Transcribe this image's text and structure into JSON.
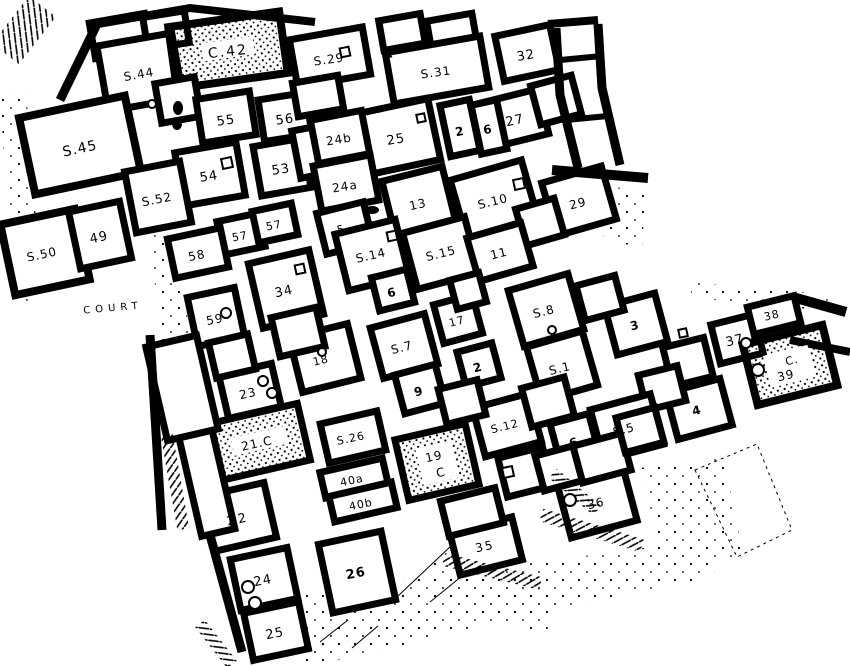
{
  "figure": {
    "kind": "excavation-site-plan",
    "colors": {
      "ink": "#000000",
      "paper": "#ffffff"
    }
  },
  "map": {
    "labels": [
      {
        "text": "C.42",
        "x": 228,
        "y": 52,
        "size": 14,
        "ls": 2,
        "rot": -6
      },
      {
        "text": "S.44",
        "x": 139,
        "y": 75,
        "size": 12,
        "rot": -10
      },
      {
        "text": "S.29",
        "x": 329,
        "y": 60,
        "size": 12,
        "rot": -8
      },
      {
        "text": "S.31",
        "x": 436,
        "y": 73,
        "size": 12,
        "rot": -8
      },
      {
        "text": "32",
        "x": 526,
        "y": 56,
        "size": 13,
        "rot": -10
      },
      {
        "text": "55",
        "x": 226,
        "y": 121,
        "size": 13,
        "rot": -8
      },
      {
        "text": "56",
        "x": 285,
        "y": 120,
        "size": 13,
        "rot": -8
      },
      {
        "text": "27",
        "x": 515,
        "y": 121,
        "size": 13,
        "rot": -12
      },
      {
        "text": "2",
        "x": 460,
        "y": 132,
        "size": 12,
        "bold": true,
        "rot": -10
      },
      {
        "text": "6",
        "x": 488,
        "y": 130,
        "size": 12,
        "bold": true,
        "rot": -10
      },
      {
        "text": "25",
        "x": 396,
        "y": 140,
        "size": 13,
        "rot": -10
      },
      {
        "text": "24b",
        "x": 339,
        "y": 140,
        "size": 12,
        "rot": -9
      },
      {
        "text": "S.45",
        "x": 80,
        "y": 149,
        "size": 14,
        "rot": -12
      },
      {
        "text": "54",
        "x": 209,
        "y": 177,
        "size": 13,
        "rot": -9
      },
      {
        "text": "53",
        "x": 281,
        "y": 170,
        "size": 13,
        "rot": -9
      },
      {
        "text": "24a",
        "x": 345,
        "y": 187,
        "size": 12,
        "rot": -9
      },
      {
        "text": "S.52",
        "x": 157,
        "y": 200,
        "size": 12,
        "rot": -11
      },
      {
        "text": "13",
        "x": 418,
        "y": 205,
        "size": 12,
        "rot": -12
      },
      {
        "text": "S.10",
        "x": 493,
        "y": 202,
        "size": 12,
        "rot": -14
      },
      {
        "text": "29",
        "x": 578,
        "y": 204,
        "size": 12,
        "rot": -14
      },
      {
        "text": "49",
        "x": 99,
        "y": 238,
        "size": 13,
        "rot": -12
      },
      {
        "text": "S.50",
        "x": 42,
        "y": 255,
        "size": 12,
        "rot": -12
      },
      {
        "text": "57",
        "x": 240,
        "y": 237,
        "size": 11,
        "rot": -11
      },
      {
        "text": "57",
        "x": 274,
        "y": 226,
        "size": 11,
        "rot": -11
      },
      {
        "text": "58",
        "x": 197,
        "y": 256,
        "size": 12,
        "rot": -11
      },
      {
        "text": "5",
        "x": 341,
        "y": 230,
        "size": 11,
        "rot": -12
      },
      {
        "text": "S.14",
        "x": 371,
        "y": 256,
        "size": 12,
        "rot": -13
      },
      {
        "text": "S.15",
        "x": 441,
        "y": 254,
        "size": 12,
        "rot": -14
      },
      {
        "text": "11",
        "x": 499,
        "y": 254,
        "size": 12,
        "rot": -14
      },
      {
        "text": "34",
        "x": 284,
        "y": 292,
        "size": 13,
        "rot": -12
      },
      {
        "text": "COURT",
        "x": 113,
        "y": 308,
        "size": 10,
        "ls": 5,
        "rot": -5
      },
      {
        "text": "59",
        "x": 215,
        "y": 320,
        "size": 12,
        "rot": -11
      },
      {
        "text": "6",
        "x": 392,
        "y": 293,
        "size": 12,
        "bold": true,
        "rot": -13
      },
      {
        "text": "17",
        "x": 457,
        "y": 322,
        "size": 11,
        "rot": -14
      },
      {
        "text": "S.8",
        "x": 544,
        "y": 312,
        "size": 12,
        "rot": -14
      },
      {
        "text": "3",
        "x": 635,
        "y": 326,
        "size": 12,
        "bold": true,
        "rot": -14
      },
      {
        "text": "38",
        "x": 772,
        "y": 316,
        "size": 11,
        "rot": -13
      },
      {
        "text": "37",
        "x": 735,
        "y": 341,
        "size": 13,
        "rot": -13
      },
      {
        "text": "C.",
        "x": 792,
        "y": 361,
        "size": 11,
        "rot": -13
      },
      {
        "text": "39",
        "x": 786,
        "y": 376,
        "size": 12,
        "rot": -13
      },
      {
        "text": "18",
        "x": 321,
        "y": 361,
        "size": 11,
        "rot": -13
      },
      {
        "text": "S.7",
        "x": 402,
        "y": 348,
        "size": 12,
        "rot": -14
      },
      {
        "text": "2",
        "x": 478,
        "y": 368,
        "size": 12,
        "bold": true,
        "rot": -14
      },
      {
        "text": "S.1",
        "x": 560,
        "y": 369,
        "size": 12,
        "rot": -14
      },
      {
        "text": "23",
        "x": 248,
        "y": 394,
        "size": 12,
        "rot": -12
      },
      {
        "text": "9",
        "x": 419,
        "y": 392,
        "size": 12,
        "bold": true,
        "rot": -14
      },
      {
        "text": "4",
        "x": 697,
        "y": 411,
        "size": 12,
        "bold": true,
        "rot": -14
      },
      {
        "text": "S.5",
        "x": 624,
        "y": 430,
        "size": 12,
        "rot": -14
      },
      {
        "text": "S.12",
        "x": 505,
        "y": 427,
        "size": 11,
        "rot": -14
      },
      {
        "text": "6",
        "x": 574,
        "y": 443,
        "size": 12,
        "bold": true,
        "rot": -14
      },
      {
        "text": "21.C",
        "x": 257,
        "y": 444,
        "size": 12,
        "rot": -12
      },
      {
        "text": "S.26",
        "x": 351,
        "y": 439,
        "size": 11,
        "rot": -12
      },
      {
        "text": "19",
        "x": 434,
        "y": 457,
        "size": 12,
        "rot": -12
      },
      {
        "text": "C",
        "x": 441,
        "y": 473,
        "size": 12,
        "rot": -12
      },
      {
        "text": "40a",
        "x": 352,
        "y": 481,
        "size": 11,
        "rot": -12
      },
      {
        "text": "40b",
        "x": 361,
        "y": 505,
        "size": 11,
        "rot": -12
      },
      {
        "text": "22",
        "x": 238,
        "y": 520,
        "size": 13,
        "ls": 3,
        "rot": -12
      },
      {
        "text": "36",
        "x": 596,
        "y": 504,
        "size": 12,
        "rot": -13
      },
      {
        "text": "35",
        "x": 485,
        "y": 547,
        "size": 12,
        "ls": 2,
        "rot": -12
      },
      {
        "text": "24",
        "x": 263,
        "y": 581,
        "size": 13,
        "rot": -11
      },
      {
        "text": "26",
        "x": 356,
        "y": 574,
        "size": 13,
        "bold": true,
        "rot": -11
      },
      {
        "text": "25",
        "x": 275,
        "y": 634,
        "size": 13,
        "rot": -11
      }
    ],
    "rooms": [
      {
        "cx": 120,
        "cy": 36,
        "w": 56,
        "h": 36,
        "rot": -10
      },
      {
        "cx": 166,
        "cy": 30,
        "w": 42,
        "h": 32,
        "rot": -9
      },
      {
        "cx": 140,
        "cy": 72,
        "w": 76,
        "h": 66,
        "rot": -10
      },
      {
        "cx": 228,
        "cy": 50,
        "w": 112,
        "h": 62,
        "rot": -8,
        "fill": "stipple",
        "sw": 8
      },
      {
        "cx": 178,
        "cy": 100,
        "w": 40,
        "h": 40,
        "rot": -10
      },
      {
        "cx": 80,
        "cy": 145,
        "w": 108,
        "h": 78,
        "rot": -12,
        "sw": 8
      },
      {
        "cx": 45,
        "cy": 252,
        "w": 76,
        "h": 72,
        "rot": -12,
        "sw": 8
      },
      {
        "cx": 100,
        "cy": 235,
        "w": 52,
        "h": 58,
        "rot": -12
      },
      {
        "cx": 226,
        "cy": 117,
        "w": 54,
        "h": 44,
        "rot": -9
      },
      {
        "cx": 285,
        "cy": 117,
        "w": 48,
        "h": 42,
        "rot": -9
      },
      {
        "cx": 210,
        "cy": 174,
        "w": 62,
        "h": 54,
        "rot": -10
      },
      {
        "cx": 282,
        "cy": 167,
        "w": 50,
        "h": 50,
        "rot": -10
      },
      {
        "cx": 158,
        "cy": 197,
        "w": 56,
        "h": 62,
        "rot": -11
      },
      {
        "cx": 310,
        "cy": 152,
        "w": 28,
        "h": 48,
        "rot": -11
      },
      {
        "cx": 330,
        "cy": 57,
        "w": 74,
        "h": 48,
        "rot": -10
      },
      {
        "cx": 318,
        "cy": 96,
        "w": 46,
        "h": 34,
        "rot": -10
      },
      {
        "cx": 402,
        "cy": 32,
        "w": 42,
        "h": 30,
        "rot": -10
      },
      {
        "cx": 452,
        "cy": 33,
        "w": 46,
        "h": 32,
        "rot": -10
      },
      {
        "cx": 437,
        "cy": 70,
        "w": 96,
        "h": 52,
        "rot": -10
      },
      {
        "cx": 527,
        "cy": 53,
        "w": 56,
        "h": 46,
        "rot": -12
      },
      {
        "cx": 516,
        "cy": 118,
        "w": 56,
        "h": 46,
        "rot": -14
      },
      {
        "cx": 556,
        "cy": 100,
        "w": 42,
        "h": 40,
        "rot": -15
      },
      {
        "cx": 460,
        "cy": 128,
        "w": 30,
        "h": 52,
        "rot": -12
      },
      {
        "cx": 489,
        "cy": 127,
        "w": 26,
        "h": 50,
        "rot": -12
      },
      {
        "cx": 397,
        "cy": 137,
        "w": 76,
        "h": 62,
        "rot": -12
      },
      {
        "cx": 340,
        "cy": 137,
        "w": 52,
        "h": 44,
        "rot": -11
      },
      {
        "cx": 346,
        "cy": 183,
        "w": 58,
        "h": 46,
        "rot": -11
      },
      {
        "cx": 419,
        "cy": 202,
        "w": 62,
        "h": 58,
        "rot": -14
      },
      {
        "cx": 494,
        "cy": 199,
        "w": 74,
        "h": 60,
        "rot": -16
      },
      {
        "cx": 579,
        "cy": 201,
        "w": 62,
        "h": 55,
        "rot": -16
      },
      {
        "cx": 540,
        "cy": 222,
        "w": 40,
        "h": 38,
        "rot": -16
      },
      {
        "cx": 241,
        "cy": 234,
        "w": 42,
        "h": 34,
        "rot": -12
      },
      {
        "cx": 275,
        "cy": 223,
        "w": 40,
        "h": 32,
        "rot": -12
      },
      {
        "cx": 198,
        "cy": 253,
        "w": 54,
        "h": 40,
        "rot": -12
      },
      {
        "cx": 345,
        "cy": 228,
        "w": 48,
        "h": 42,
        "rot": -14
      },
      {
        "cx": 372,
        "cy": 255,
        "w": 62,
        "h": 58,
        "rot": -14
      },
      {
        "cx": 441,
        "cy": 253,
        "w": 64,
        "h": 58,
        "rot": -15
      },
      {
        "cx": 500,
        "cy": 252,
        "w": 56,
        "h": 45,
        "rot": -16
      },
      {
        "cx": 286,
        "cy": 289,
        "w": 62,
        "h": 66,
        "rot": -13
      },
      {
        "cx": 216,
        "cy": 317,
        "w": 48,
        "h": 50,
        "rot": -12
      },
      {
        "cx": 393,
        "cy": 290,
        "w": 36,
        "h": 34,
        "rot": -14
      },
      {
        "cx": 458,
        "cy": 319,
        "w": 40,
        "h": 40,
        "rot": -15
      },
      {
        "cx": 468,
        "cy": 291,
        "w": 30,
        "h": 30,
        "rot": -15
      },
      {
        "cx": 546,
        "cy": 310,
        "w": 62,
        "h": 58,
        "rot": -16
      },
      {
        "cx": 325,
        "cy": 358,
        "w": 60,
        "h": 56,
        "rot": -14
      },
      {
        "cx": 404,
        "cy": 346,
        "w": 56,
        "h": 52,
        "rot": -15
      },
      {
        "cx": 479,
        "cy": 365,
        "w": 36,
        "h": 36,
        "rot": -15
      },
      {
        "cx": 562,
        "cy": 366,
        "w": 58,
        "h": 56,
        "rot": -16
      },
      {
        "cx": 420,
        "cy": 389,
        "w": 42,
        "h": 40,
        "rot": -15
      },
      {
        "cx": 250,
        "cy": 391,
        "w": 54,
        "h": 44,
        "rot": -13
      },
      {
        "cx": 232,
        "cy": 356,
        "w": 40,
        "h": 36,
        "rot": -13
      },
      {
        "cx": 298,
        "cy": 332,
        "w": 46,
        "h": 40,
        "rot": -13
      },
      {
        "cx": 636,
        "cy": 324,
        "w": 52,
        "h": 50,
        "rot": -15
      },
      {
        "cx": 600,
        "cy": 298,
        "w": 40,
        "h": 36,
        "rot": -15
      },
      {
        "cx": 737,
        "cy": 339,
        "w": 44,
        "h": 40,
        "rot": -14
      },
      {
        "cx": 774,
        "cy": 315,
        "w": 48,
        "h": 28,
        "rot": -14
      },
      {
        "cx": 790,
        "cy": 365,
        "w": 82,
        "h": 62,
        "rot": -14,
        "fill": "stipple",
        "sw": 8
      },
      {
        "cx": 699,
        "cy": 409,
        "w": 56,
        "h": 48,
        "rot": -15
      },
      {
        "cx": 688,
        "cy": 362,
        "w": 42,
        "h": 40,
        "rot": -14
      },
      {
        "cx": 662,
        "cy": 388,
        "w": 40,
        "h": 36,
        "rot": -14
      },
      {
        "cx": 627,
        "cy": 427,
        "w": 62,
        "h": 52,
        "rot": -15
      },
      {
        "cx": 575,
        "cy": 440,
        "w": 40,
        "h": 44,
        "rot": -15
      },
      {
        "cx": 507,
        "cy": 425,
        "w": 58,
        "h": 50,
        "rot": -15
      },
      {
        "cx": 548,
        "cy": 402,
        "w": 44,
        "h": 40,
        "rot": -15
      },
      {
        "cx": 462,
        "cy": 402,
        "w": 40,
        "h": 36,
        "rot": -14
      },
      {
        "cx": 259,
        "cy": 442,
        "w": 92,
        "h": 58,
        "rot": -13,
        "fill": "stipple"
      },
      {
        "cx": 353,
        "cy": 437,
        "w": 58,
        "h": 40,
        "rot": -13
      },
      {
        "cx": 437,
        "cy": 462,
        "w": 72,
        "h": 62,
        "rot": -13,
        "fill": "stipple"
      },
      {
        "cx": 354,
        "cy": 478,
        "w": 64,
        "h": 26,
        "rot": -13
      },
      {
        "cx": 363,
        "cy": 502,
        "w": 64,
        "h": 26,
        "rot": -13
      },
      {
        "cx": 239,
        "cy": 517,
        "w": 64,
        "h": 56,
        "rot": -13
      },
      {
        "cx": 205,
        "cy": 475,
        "w": 34,
        "h": 118,
        "rot": -13
      },
      {
        "cx": 182,
        "cy": 388,
        "w": 52,
        "h": 96,
        "rot": -13
      },
      {
        "cx": 264,
        "cy": 579,
        "w": 58,
        "h": 52,
        "rot": -12
      },
      {
        "cx": 357,
        "cy": 572,
        "w": 64,
        "h": 70,
        "rot": -12
      },
      {
        "cx": 276,
        "cy": 631,
        "w": 56,
        "h": 48,
        "rot": -12
      },
      {
        "cx": 486,
        "cy": 546,
        "w": 64,
        "h": 44,
        "rot": -14
      },
      {
        "cx": 597,
        "cy": 502,
        "w": 68,
        "h": 56,
        "rot": -15
      },
      {
        "cx": 472,
        "cy": 512,
        "w": 56,
        "h": 36,
        "rot": -14
      },
      {
        "cx": 525,
        "cy": 472,
        "w": 46,
        "h": 40,
        "rot": -14
      },
      {
        "cx": 560,
        "cy": 468,
        "w": 42,
        "h": 36,
        "rot": -15
      },
      {
        "cx": 602,
        "cy": 458,
        "w": 50,
        "h": 38,
        "rot": -15
      },
      {
        "cx": 640,
        "cy": 430,
        "w": 40,
        "h": 36,
        "rot": -15
      }
    ],
    "features": [
      {
        "type": "patch",
        "x": 228,
        "y": 49,
        "w": 52,
        "h": 18,
        "rot": -8
      },
      {
        "type": "patch",
        "x": 259,
        "y": 441,
        "w": 54,
        "h": 18,
        "rot": -13
      },
      {
        "type": "patch",
        "x": 437,
        "y": 463,
        "w": 36,
        "h": 38,
        "rot": -13
      },
      {
        "type": "patch",
        "x": 789,
        "y": 366,
        "w": 46,
        "h": 32,
        "rot": -14
      },
      {
        "type": "sq",
        "x": 227,
        "y": 163,
        "s": 10
      },
      {
        "type": "sq",
        "x": 345,
        "y": 52,
        "s": 9
      },
      {
        "type": "sq",
        "x": 519,
        "y": 184,
        "s": 10
      },
      {
        "type": "sq",
        "x": 508,
        "y": 472,
        "s": 10
      },
      {
        "type": "sq",
        "x": 300,
        "y": 269,
        "s": 9
      },
      {
        "type": "sq",
        "x": 392,
        "y": 236,
        "s": 9
      },
      {
        "type": "sq",
        "x": 421,
        "y": 118,
        "s": 8
      },
      {
        "type": "sq",
        "x": 683,
        "y": 333,
        "s": 8
      },
      {
        "type": "circle",
        "x": 152,
        "y": 104,
        "r": 4
      },
      {
        "type": "circle",
        "x": 226,
        "y": 313,
        "r": 5
      },
      {
        "type": "circle",
        "x": 263,
        "y": 381,
        "r": 5
      },
      {
        "type": "circle",
        "x": 272,
        "y": 393,
        "r": 5
      },
      {
        "type": "circle",
        "x": 746,
        "y": 343,
        "r": 5
      },
      {
        "type": "circle",
        "x": 758,
        "y": 370,
        "r": 6
      },
      {
        "type": "circle",
        "x": 570,
        "y": 500,
        "r": 6
      },
      {
        "type": "circle",
        "x": 248,
        "y": 587,
        "r": 6
      },
      {
        "type": "circle",
        "x": 255,
        "y": 603,
        "r": 6
      },
      {
        "type": "circle",
        "x": 322,
        "y": 352,
        "r": 4
      },
      {
        "type": "circle",
        "x": 552,
        "y": 330,
        "r": 4
      },
      {
        "type": "blob",
        "x": 178,
        "y": 108,
        "rx": 5,
        "ry": 7
      },
      {
        "type": "blob",
        "x": 177,
        "y": 124,
        "rx": 5,
        "ry": 6
      },
      {
        "type": "blob",
        "x": 372,
        "y": 210,
        "rx": 7,
        "ry": 4
      },
      {
        "type": "tri",
        "x": 388,
        "y": 53,
        "s": 9
      }
    ]
  }
}
